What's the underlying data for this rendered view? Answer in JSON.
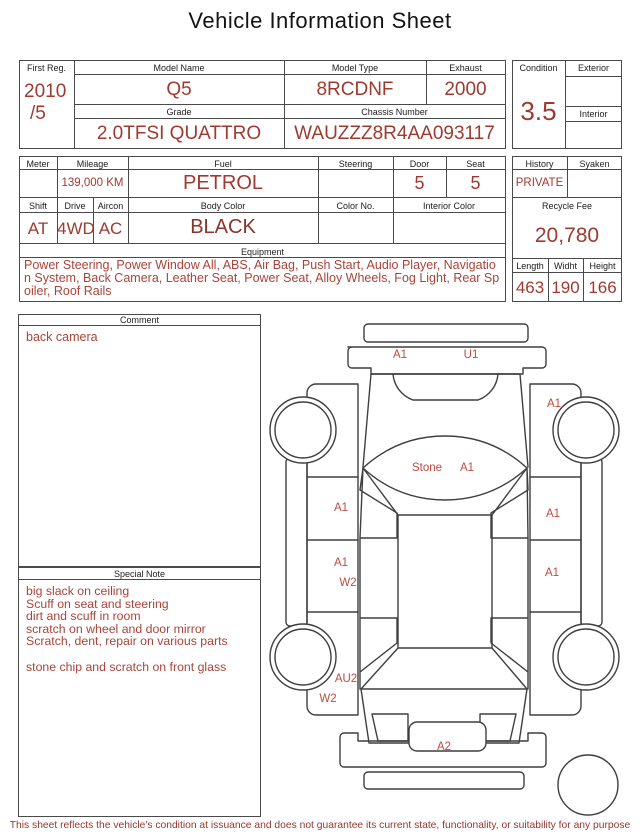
{
  "title": "Vehicle Information Sheet",
  "colors": {
    "value_red": "#a03a30",
    "note_red": "#a8443a",
    "diagram_red": "#c0493f",
    "border_gray": "#4a4a4a"
  },
  "table1": {
    "first_reg": {
      "label": "First Reg.",
      "line1": "2010",
      "line2": "/5"
    },
    "model_name": {
      "label": "Model Name",
      "value": "Q5"
    },
    "model_type": {
      "label": "Model Type",
      "value": "8RCDNF"
    },
    "exhaust": {
      "label": "Exhaust",
      "value": "2000"
    },
    "grade": {
      "label": "Grade",
      "value": "2.0TFSI QUATTRO"
    },
    "chassis": {
      "label": "Chassis Number",
      "value": "WAUZZZ8R4AA093117"
    },
    "condition": {
      "label": "Condition",
      "value": "3.5"
    },
    "exterior": {
      "label": "Exterior",
      "value": ""
    },
    "interior": {
      "label": "Interior",
      "value": ""
    }
  },
  "table2": {
    "meter": {
      "label": "Meter",
      "value": ""
    },
    "mileage": {
      "label": "Mileage",
      "value": "139,000 KM"
    },
    "fuel": {
      "label": "Fuel",
      "value": "PETROL"
    },
    "steering": {
      "label": "Steering",
      "value": ""
    },
    "door": {
      "label": "Door",
      "value": "5"
    },
    "seat": {
      "label": "Seat",
      "value": "5"
    },
    "shift": {
      "label": "Shift",
      "value": "AT"
    },
    "drive": {
      "label": "Drive",
      "value": "4WD"
    },
    "aircon": {
      "label": "Aircon",
      "value": "AC"
    },
    "body_color": {
      "label": "Body Color",
      "value": "BLACK"
    },
    "color_no": {
      "label": "Color No.",
      "value": ""
    },
    "interior_color": {
      "label": "Interior Color",
      "value": ""
    },
    "equipment": {
      "label": "Equipment",
      "value": "Power Steering, Power Window All, ABS, Air Bag, Push Start, Audio Player, Navigation System, Back Camera, Leather Seat, Power Seat, Alloy Wheels, Fog Light, Rear Spoiler, Roof Rails"
    }
  },
  "side": {
    "history": {
      "label": "History",
      "value": "PRIVATE"
    },
    "syaken": {
      "label": "Syaken",
      "value": ""
    },
    "recycle_fee": {
      "label": "Recycle Fee",
      "value": "20,780"
    },
    "length": {
      "label": "Length",
      "value": "463"
    },
    "width": {
      "label": "Widht",
      "value": "190"
    },
    "height": {
      "label": "Height",
      "value": "166"
    }
  },
  "comment": {
    "label": "Comment",
    "text": "back camera"
  },
  "special_note": {
    "label": "Special Note",
    "lines": [
      "big slack on ceiling",
      "Scuff on seat and steering",
      "dirt and scuff in room",
      "scratch on wheel and door mirror",
      "Scratch, dent, repair on various parts",
      "",
      "stone chip and scratch on front glass"
    ]
  },
  "diagram": {
    "labels": [
      {
        "text": "A1",
        "x": 400,
        "y": 358
      },
      {
        "text": "U1",
        "x": 471,
        "y": 358
      },
      {
        "text": "A1",
        "x": 554,
        "y": 407
      },
      {
        "text": "Stone",
        "x": 427,
        "y": 471
      },
      {
        "text": "A1",
        "x": 467,
        "y": 471
      },
      {
        "text": "A1",
        "x": 341,
        "y": 511
      },
      {
        "text": "A1",
        "x": 553,
        "y": 517
      },
      {
        "text": "A1",
        "x": 341,
        "y": 566
      },
      {
        "text": "W2",
        "x": 348,
        "y": 586
      },
      {
        "text": "A1",
        "x": 552,
        "y": 576
      },
      {
        "text": "AU2",
        "x": 346,
        "y": 682
      },
      {
        "text": "W2",
        "x": 328,
        "y": 702
      },
      {
        "text": "A2",
        "x": 444,
        "y": 750
      }
    ]
  },
  "footer": "This sheet reflects the vehicle's condition at issuance and does not guarantee its current state, functionality, or suitability for any purpose"
}
